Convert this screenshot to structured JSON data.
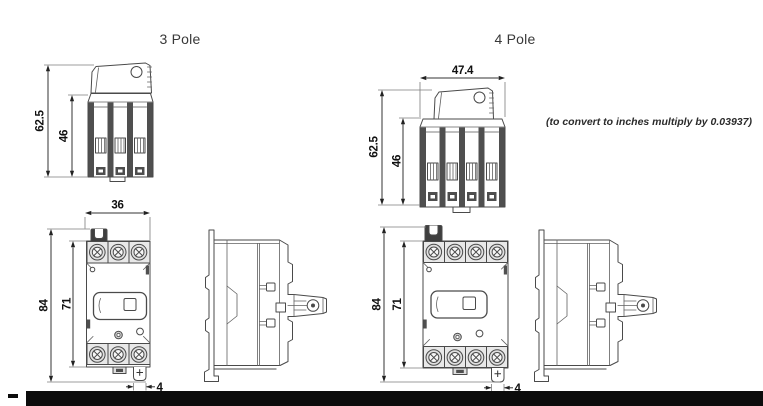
{
  "page": {
    "background": "#ffffff",
    "line_color": "#4a4a4a",
    "text_color": "#101010",
    "footer_bar_color": "#0c0c0c"
  },
  "header": {
    "three_pole_title": "3 Pole",
    "four_pole_title": "4 Pole",
    "conversion_note": "(to convert to inches multiply by 0.03937)"
  },
  "dimensions_mm": {
    "three_pole": {
      "top_view": {
        "overall_height": "62.5",
        "body_height": "46"
      },
      "front_view": {
        "width": "36",
        "overall_height": "84",
        "body_height": "71",
        "foot_slot_width": "4"
      }
    },
    "four_pole": {
      "top_view": {
        "width": "47.4",
        "overall_height": "62.5",
        "body_height": "46"
      },
      "front_view": {
        "overall_height": "84",
        "body_height": "71",
        "foot_slot_width": "4"
      }
    }
  }
}
